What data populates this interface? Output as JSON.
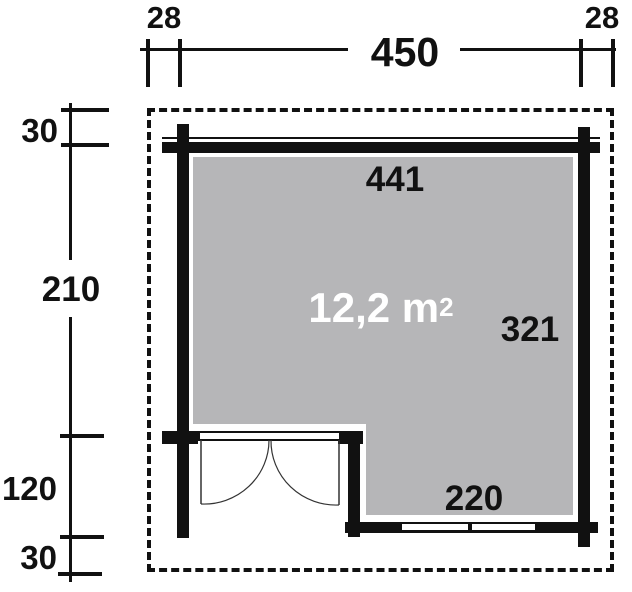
{
  "plan": {
    "type": "floor-plan",
    "area": {
      "value": "12,2 m",
      "sup": "2"
    },
    "dimensions": {
      "overhang_left": "28",
      "total_width": "450",
      "overhang_right": "28",
      "overhang_top": "30",
      "side_depth": "210",
      "door_section": "120",
      "overhang_bottom": "30",
      "interior_width": "441",
      "interior_depth": "321",
      "window_wall": "220"
    },
    "colors": {
      "line": "#111111",
      "floor": "#b6b6b8",
      "area_text": "#ffffff",
      "background": "#ffffff"
    }
  }
}
